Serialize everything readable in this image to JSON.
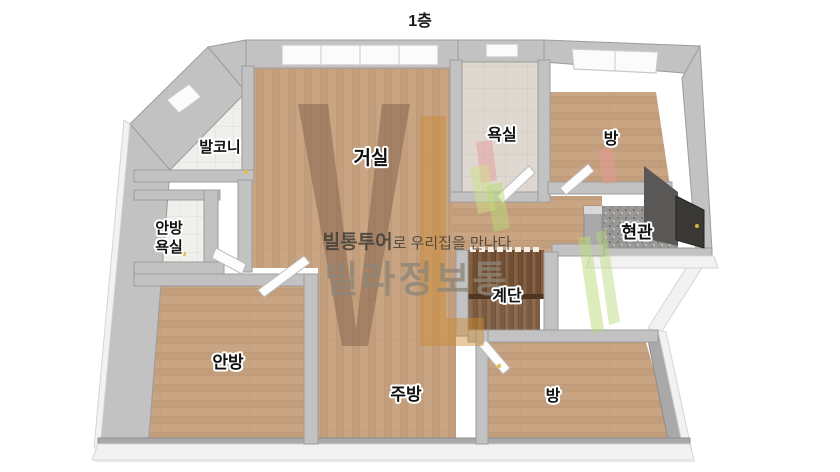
{
  "page": {
    "title": "1층"
  },
  "floorplan": {
    "rooms": {
      "balcony": "발코니",
      "living": "거실",
      "bathroom": "욕실",
      "bedroom_top": "방",
      "master_bathroom_line1": "안방",
      "master_bathroom_line2": "욕실",
      "entrance": "현관",
      "stairs": "계단",
      "master_bedroom": "안방",
      "kitchen": "주방",
      "bedroom_bottom": "방"
    }
  },
  "watermark": {
    "tagline_bold": "빌통투어",
    "tagline_rest": "로 우리집을 만나다",
    "brand": "빌라정보통"
  },
  "palette": {
    "wood": "#c9a583",
    "wood_line": "#b8926e",
    "wall": "#c2c2c2",
    "wall_dark": "#a9a9a9",
    "tile": "#efefec",
    "bath_floor": "#ded8d0",
    "granite": "#9a9896",
    "stairs_wood": "#6f4e33",
    "entry_door": "#3a3835",
    "handle_yellow": "#e3bd4a",
    "logo_brown": "#6b4a38",
    "logo_orange": "#cf8a2e",
    "logo_green": "#b9d977",
    "logo_pink": "#e89a9a"
  }
}
